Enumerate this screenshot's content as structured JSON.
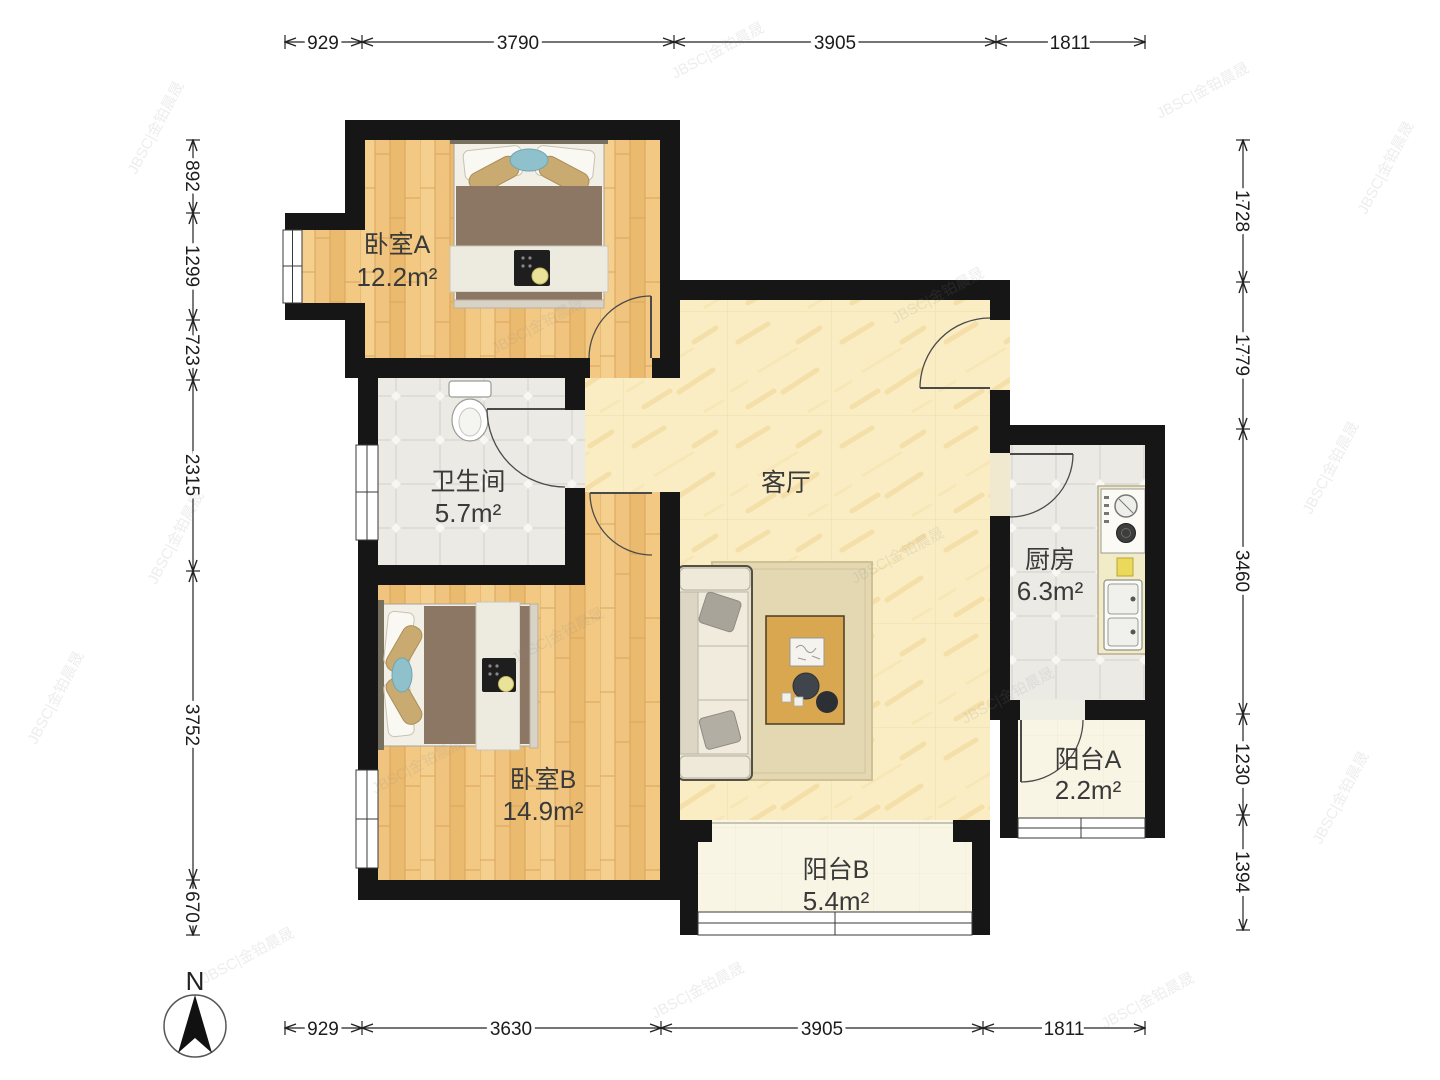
{
  "compass": {
    "label": "N"
  },
  "watermark": {
    "text": "JBSC|金铂晨晟"
  },
  "rooms": [
    {
      "name": "卧室A",
      "area": "12.2m²"
    },
    {
      "name": "卫生间",
      "area": "5.7m²"
    },
    {
      "name": "卧室B",
      "area": "14.9m²"
    },
    {
      "name": "客厅",
      "area": ""
    },
    {
      "name": "厨房",
      "area": "6.3m²"
    },
    {
      "name": "阳台A",
      "area": "2.2m²"
    },
    {
      "name": "阳台B",
      "area": "5.4m²"
    }
  ],
  "dimensions": {
    "top": [
      "929",
      "3790",
      "3905",
      "1811"
    ],
    "bottom": [
      "929",
      "3630",
      "3905",
      "1811"
    ],
    "left": [
      "892",
      "1299",
      "723",
      "2315",
      "3752",
      "670"
    ],
    "right": [
      "1728",
      "1779",
      "3460",
      "1230",
      "1394"
    ]
  }
}
